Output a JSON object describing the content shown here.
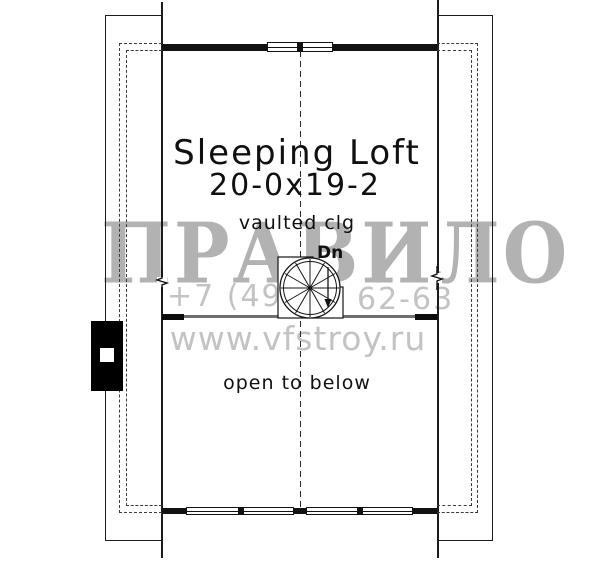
{
  "plan": {
    "room": {
      "name": "Sleeping Loft",
      "dimensions": "20-0x19-2",
      "ceiling_note": "vaulted clg"
    },
    "stair": {
      "direction_label": "Dn"
    },
    "open_area": {
      "label": "open to below"
    },
    "line_color": "#1c1c1c"
  },
  "watermark": {
    "brand": "ПРАВИЛО",
    "phone_prefix": "+7 (495)",
    "phone_suffix": "62-63",
    "website": "www.vfstroy.ru",
    "brand_color": "#b2b2b2",
    "contact_color": "#c3c3c3"
  }
}
